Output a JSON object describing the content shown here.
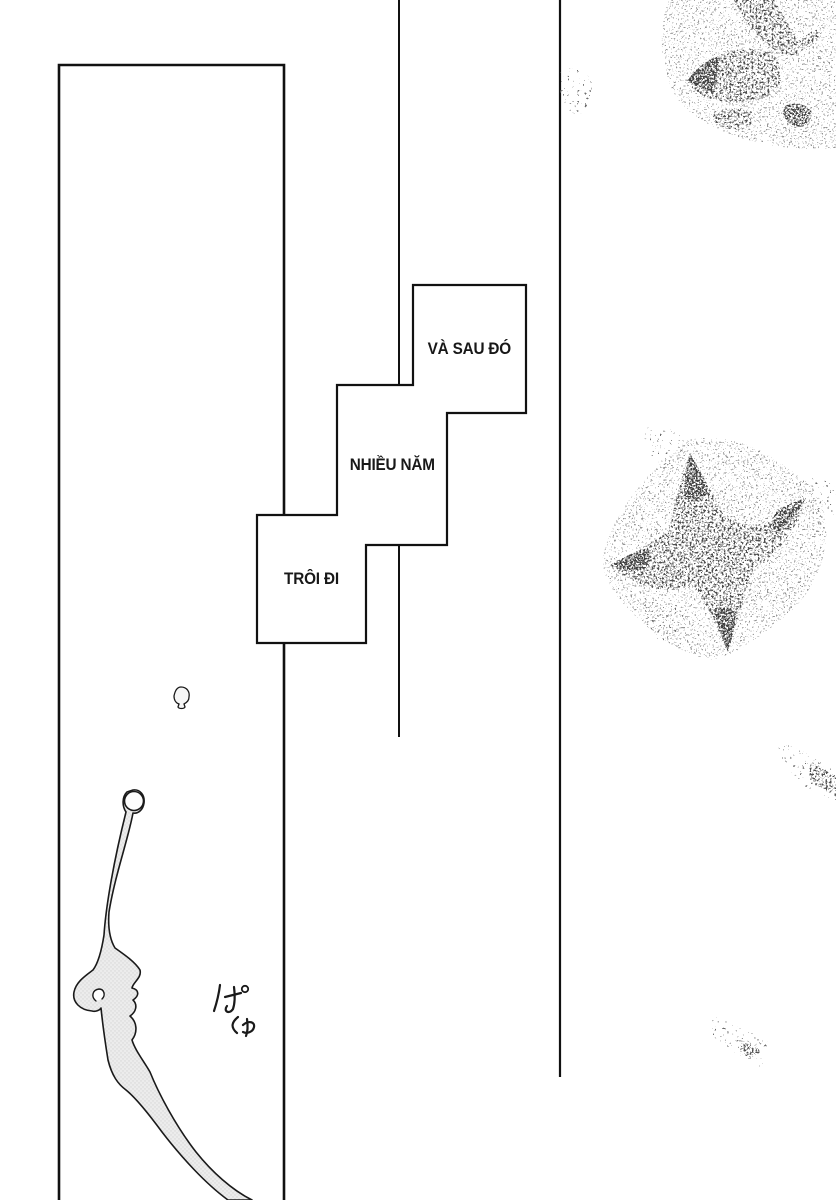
{
  "page_type": "manga-page",
  "captions": [
    {
      "id": "caption-top",
      "text": "VÀ SAU ĐÓ"
    },
    {
      "id": "caption-middle",
      "text": "NHIỀU NĂM"
    },
    {
      "id": "caption-bottom",
      "text": "TRÔI ĐI"
    }
  ],
  "artwork": {
    "sfx": "ぱしゃ",
    "elements": [
      "tall-left-panel",
      "two-vertical-gutter-lines",
      "three-step-caption-boxes",
      "stippled-butterfly-top-right",
      "stippled-butterfly-middle-right",
      "stipple-trail-right-edge",
      "stipple-trail-bottom-right",
      "ink-splash-ribbon-bottom-left",
      "small-droplet"
    ]
  },
  "colors": {
    "paper": "#ffffff",
    "ink": "#111111",
    "tone_fill": "#ececec",
    "tone_dot": "#d6d6d6"
  }
}
